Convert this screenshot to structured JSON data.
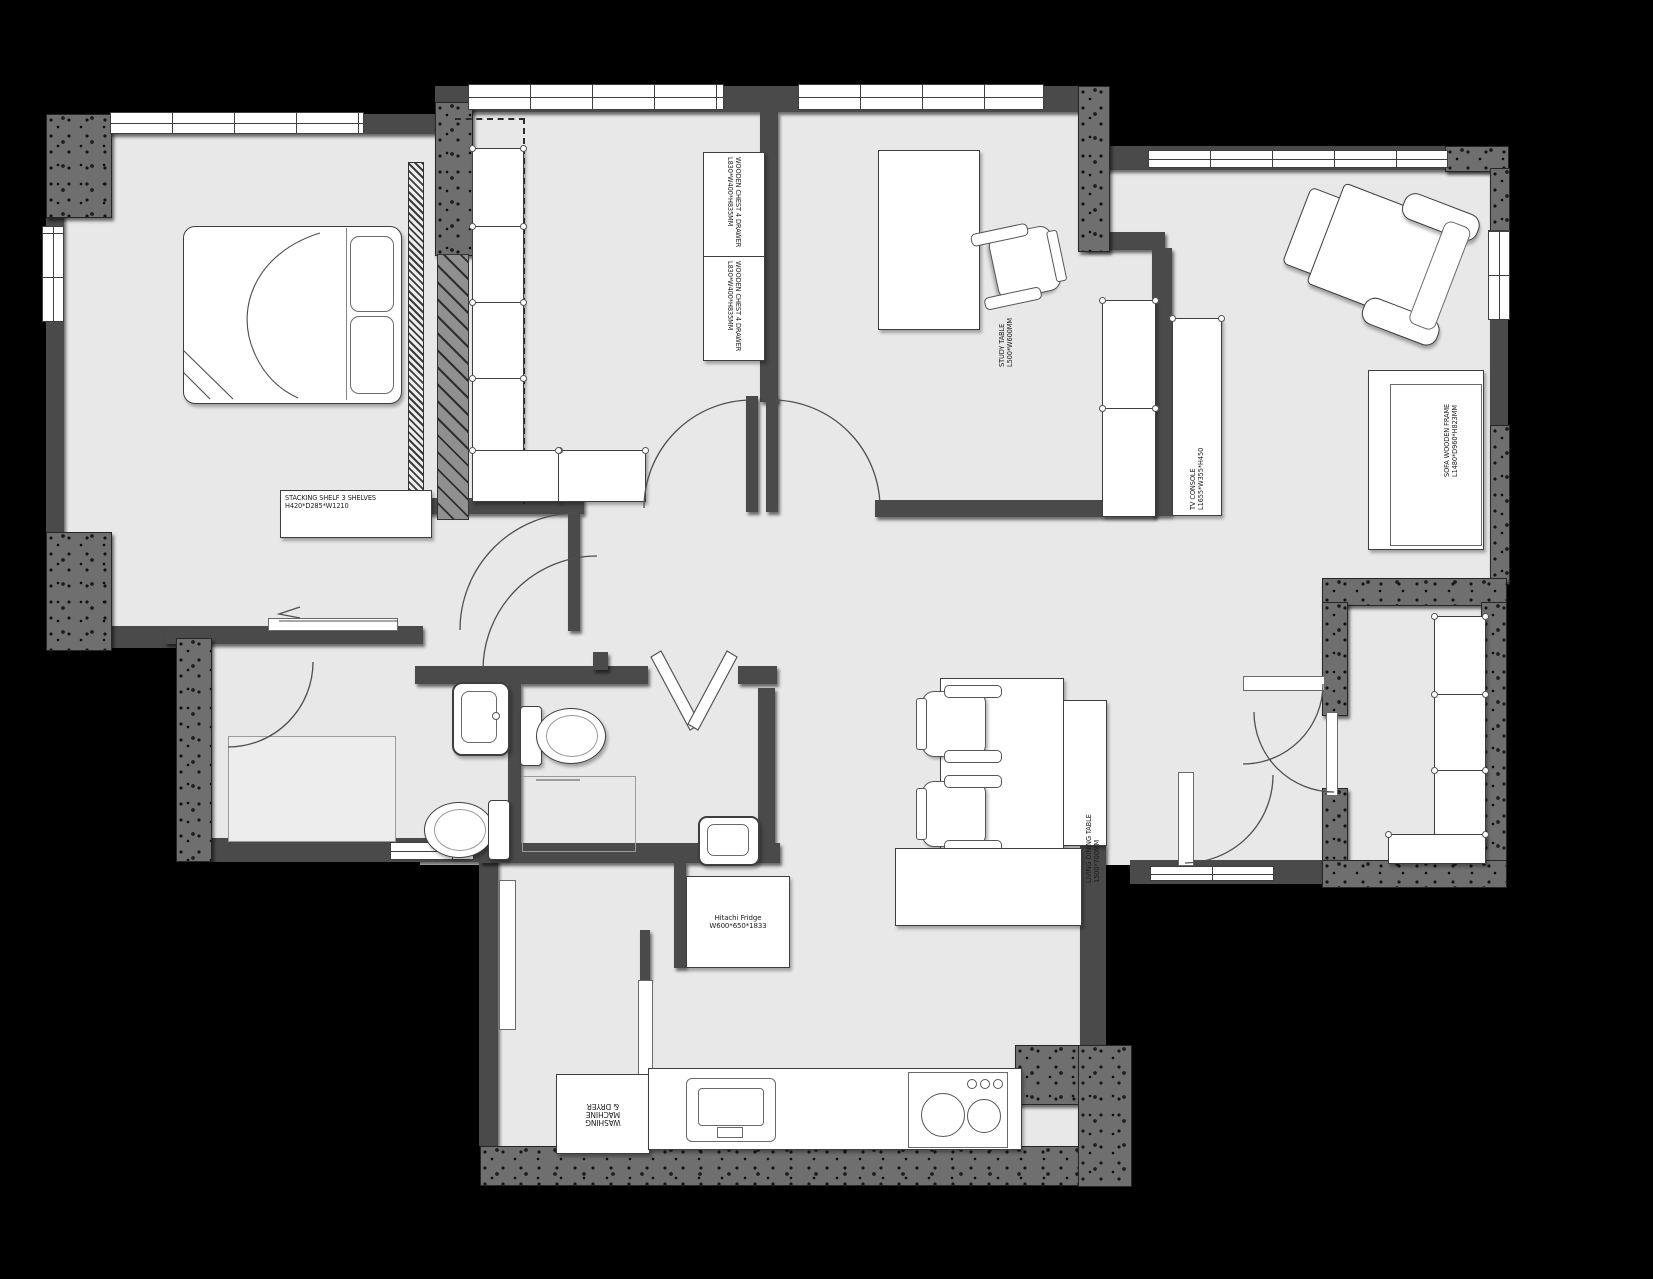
{
  "document": {
    "type": "floor-plan"
  },
  "colors": {
    "background": "#000000",
    "floor": "#e8e8e8",
    "wall": "#4a4a4a",
    "concrete": "#6f6f6f",
    "furniture": "#ffffff"
  },
  "labels": {
    "stacking_shelf": {
      "line1": "STACKING SHELF 3 SHELVES",
      "line2": "H420*D285*W1210"
    },
    "wooden_chest_1": {
      "line1": "WOODEN CHEST 4 DRAWER",
      "line2": "L830*W400*H835MM"
    },
    "wooden_chest_2": {
      "line1": "WOODEN CHEST 4 DRAWER",
      "line2": "L830*W400*H835MM"
    },
    "study_table": {
      "line1": "STUDY TABLE",
      "line2": "L500*W600MM"
    },
    "tv_console": {
      "line1": "TV CONSOLE",
      "line2": "L1655*W355*H450"
    },
    "sofa": {
      "line1": "SOFA WOODEN FRAME",
      "line2": "L1480*D960*H823MM"
    },
    "dining_table": {
      "line1": "LIVING DINING TABLE",
      "line2": "1500*700MM"
    },
    "fridge": {
      "line1": "Hitachi Fridge",
      "line2": "W600*650*1833"
    },
    "washing_machine": {
      "line1": "WASHING",
      "line2": "MACHINE",
      "line3": "& DRYER"
    }
  }
}
